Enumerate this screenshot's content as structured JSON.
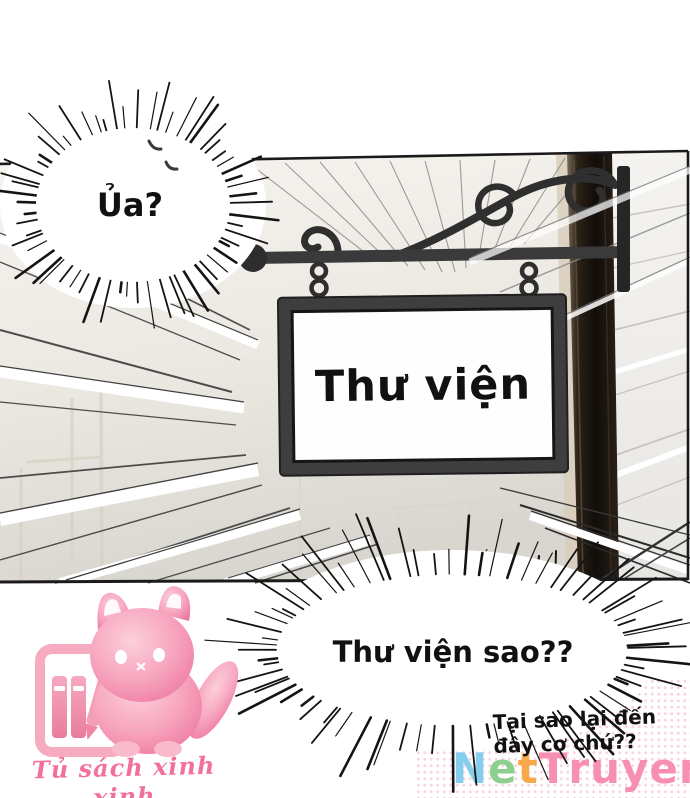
{
  "page": {
    "background": "#ffffff",
    "ink_color": "#1a1a1a"
  },
  "panel": {
    "sign": {
      "text": "Thư viện",
      "frame_color": "#3e3e3e",
      "face_color": "#fefefe"
    },
    "bracket": "wrought-iron-scroll-hanger",
    "wall_color_left": "#f6f3ee",
    "wall_color_right": "#f4f2ef",
    "post_color": "#1c1510"
  },
  "speech": {
    "exclaim_top": "Ủa?",
    "exclaim_bottom": "Thư viện sao??",
    "aside": {
      "line1": "Tại sao lại đến",
      "line2": "đây cơ chứ??"
    }
  },
  "watermarks": {
    "fanpage": {
      "label": "Tủ sách xinh xinh",
      "color": "#f2719c",
      "mascot": "pink-cat-with-bookshelf"
    },
    "site": {
      "name": "NetTruyen",
      "letters": [
        {
          "ch": "N",
          "color": "#85cdec"
        },
        {
          "ch": "e",
          "color": "#8ccf8e"
        },
        {
          "ch": "t",
          "color": "#f7a848"
        },
        {
          "ch": "T",
          "color": "#f78fb4"
        },
        {
          "ch": "r",
          "color": "#f78fb4"
        },
        {
          "ch": "u",
          "color": "#f78fb4"
        },
        {
          "ch": "y",
          "color": "#f78fb4"
        },
        {
          "ch": "e",
          "color": "#f78fb4"
        },
        {
          "ch": "n",
          "color": "#f78fb4"
        }
      ]
    }
  }
}
